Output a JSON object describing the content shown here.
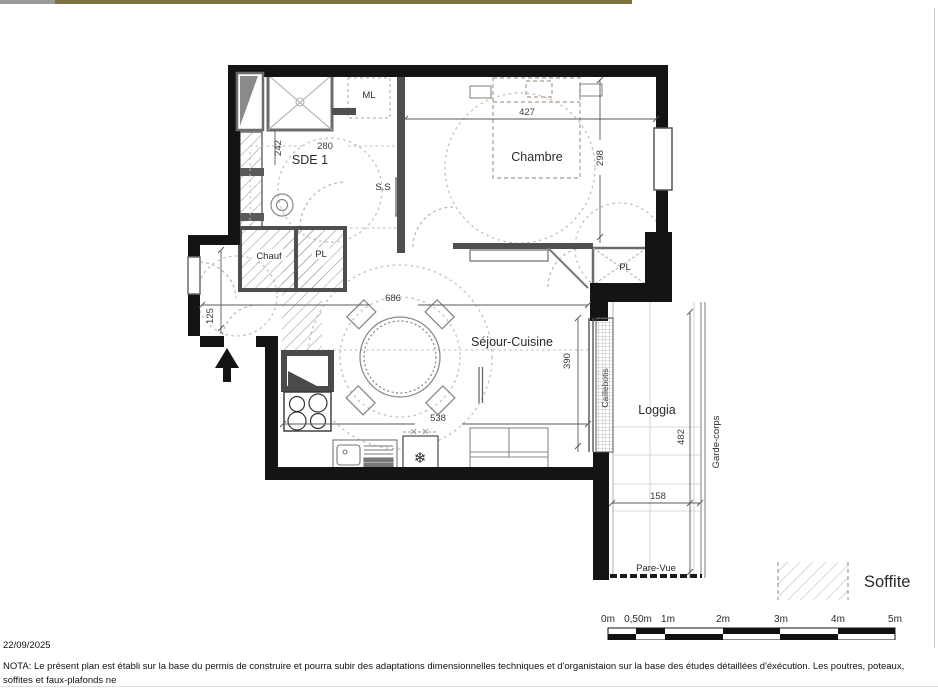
{
  "plan": {
    "rooms": {
      "sde1": "SDE 1",
      "chambre": "Chambre",
      "sejour_cuisine": "Séjour-Cuisine",
      "loggia": "Loggia"
    },
    "annotations": {
      "ml": "ML",
      "ss": "S.S",
      "chauf": "Chauf",
      "pl_entry": "PL",
      "pl_chambre": "PL",
      "caillebotis": "Caillebotis",
      "garde_corps": "Garde-corps",
      "pare_vue": "Pare-Vue"
    },
    "dimensions": {
      "sde_width": "280",
      "sde_height": "242",
      "chambre_width": "427",
      "chambre_height": "298",
      "sejour_width_top": "686",
      "sejour_width_bottom": "538",
      "sejour_height": "390",
      "entry_width": "125",
      "loggia_height": "482",
      "loggia_width": "158"
    }
  },
  "legend": {
    "soffite": "Soffite"
  },
  "scale_bar": {
    "labels": [
      "0m",
      "0,50m",
      "1m",
      "2m",
      "3m",
      "4m",
      "5m"
    ]
  },
  "footer": {
    "date": "22/09/2025",
    "nota_line1": "NOTA: Le présent plan est établi sur la base du permis de construire et pourra subir des adaptations dimensionnelles techniques et d'organistaion sur la base des études détaillées d'éxécution. Les poutres, poteaux, soffites et faux-plafonds ne",
    "nota_line2": "figurent pas forcément sur le présent plan. Les éléments de mobilier (meubles, appareils ménagers et plans de travail) ne sont placés qu'à titre indicatif."
  },
  "colors": {
    "wall": "#141414",
    "partition": "#4f4f4f",
    "fixture": "#6b6b6b",
    "furniture_line": "#8a8a8a",
    "dashed_guide": "#c9bfae",
    "hatch_line": "#9a9a9a",
    "top_strip": "#7c713f"
  }
}
